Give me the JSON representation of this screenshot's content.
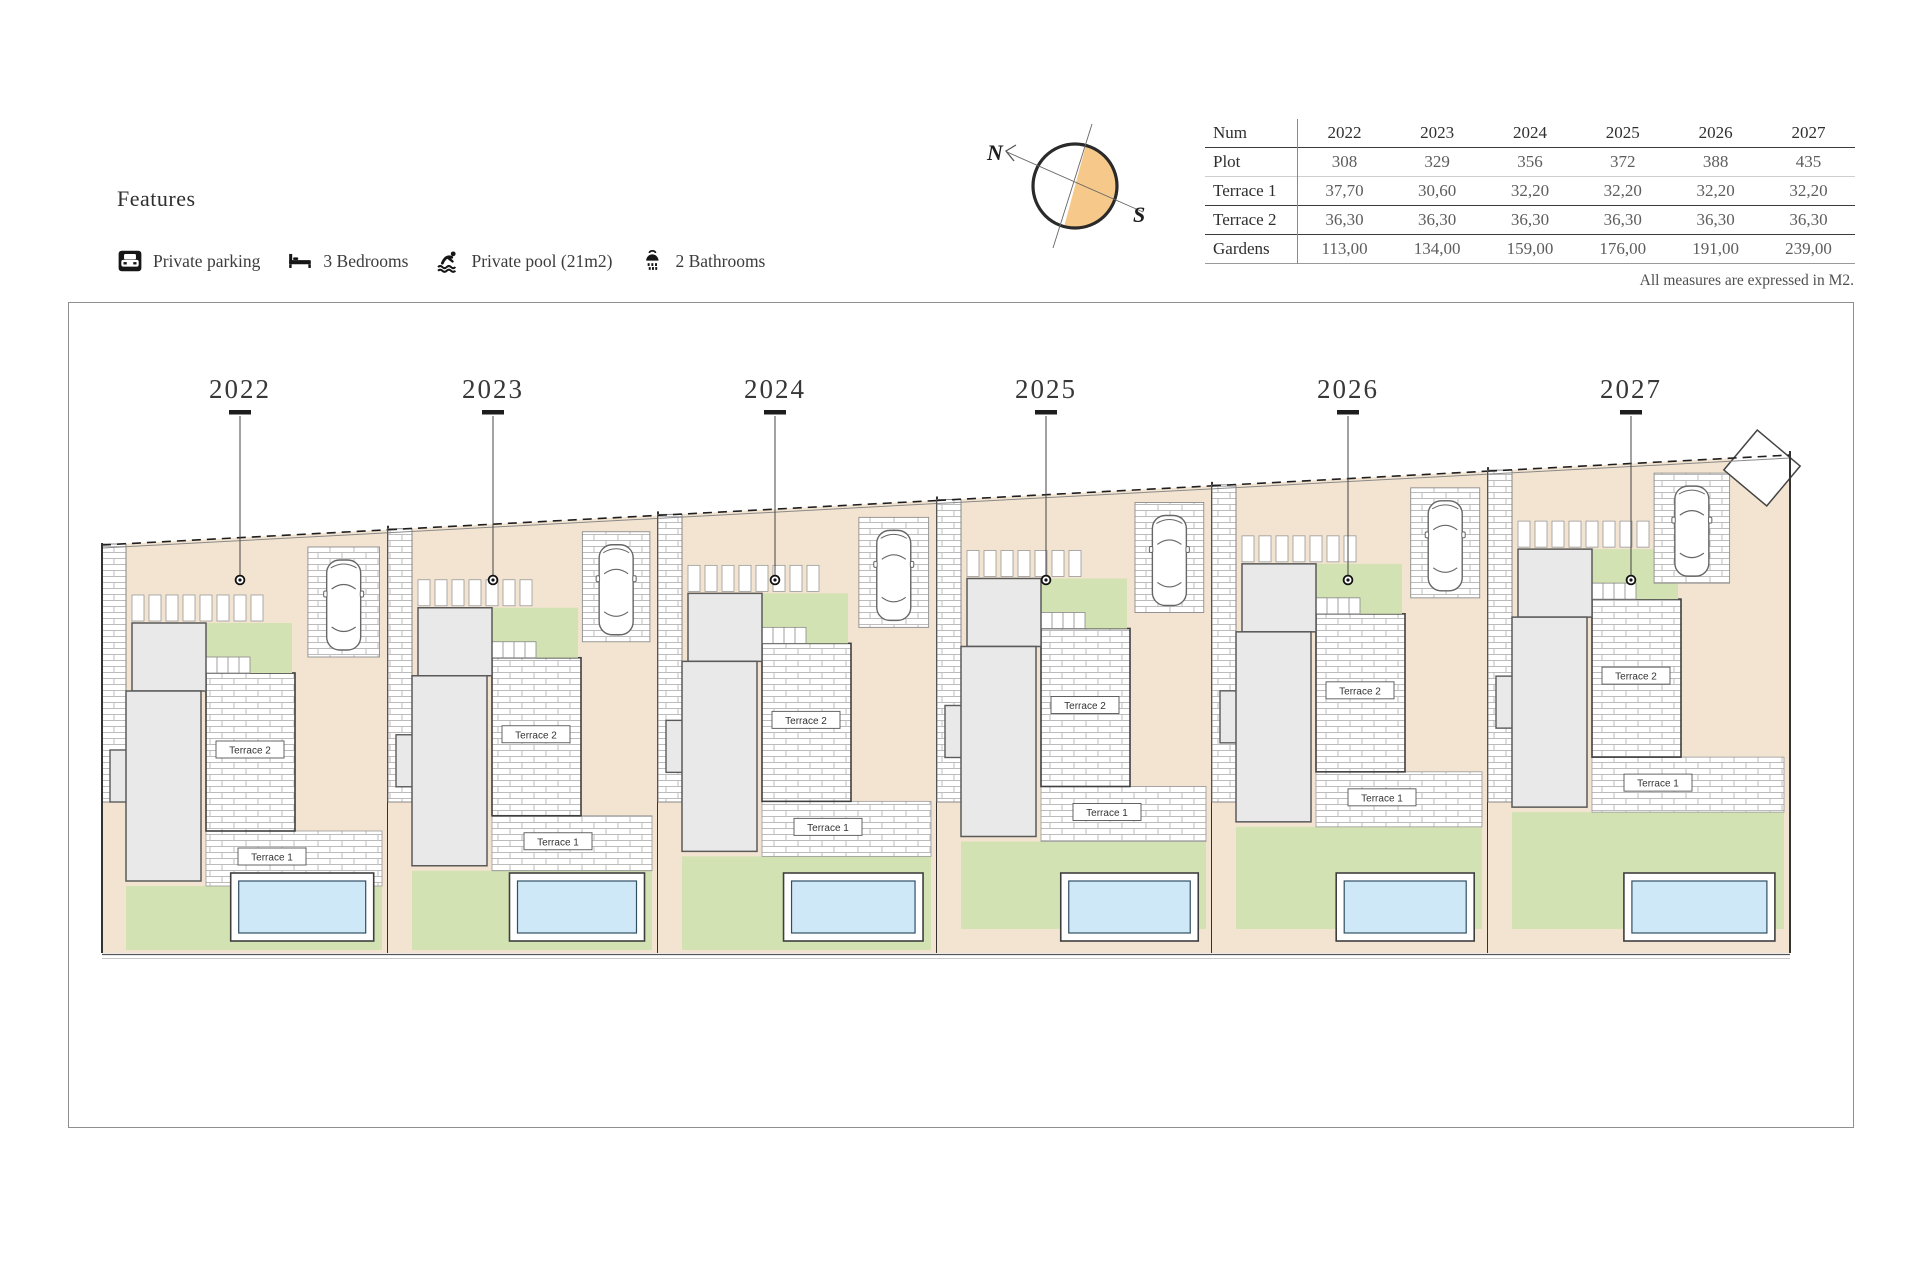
{
  "features": {
    "heading": "Features",
    "items": [
      {
        "icon": "parking-icon",
        "label": "Private parking"
      },
      {
        "icon": "bed-icon",
        "label": "3 Bedrooms"
      },
      {
        "icon": "pool-icon",
        "label": "Private pool (21m2)"
      },
      {
        "icon": "shower-icon",
        "label": "2 Bathrooms"
      }
    ]
  },
  "compass": {
    "north_label": "N",
    "south_label": "S",
    "fill_color": "#f6c98a"
  },
  "table": {
    "header": [
      "Num",
      "2022",
      "2023",
      "2024",
      "2025",
      "2026",
      "2027"
    ],
    "rows": [
      {
        "label": "Plot",
        "values": [
          "308",
          "329",
          "356",
          "372",
          "388",
          "435"
        ]
      },
      {
        "label": "Terrace 1",
        "values": [
          "37,70",
          "30,60",
          "32,20",
          "32,20",
          "32,20",
          "32,20"
        ]
      },
      {
        "label": "Terrace 2",
        "values": [
          "36,30",
          "36,30",
          "36,30",
          "36,30",
          "36,30",
          "36,30"
        ]
      },
      {
        "label": "Gardens",
        "values": [
          "113,00",
          "134,00",
          "159,00",
          "176,00",
          "191,00",
          "239,00"
        ]
      }
    ],
    "note": "All measures are expressed in M2."
  },
  "siteplan": {
    "terrace1_label": "Terrace 1",
    "terrace2_label": "Terrace 2",
    "colors": {
      "beige": "#f3e4d1",
      "green": "#d3e2b2",
      "pool_water": "#cfe8f8",
      "house_fill": "#e9e9e9",
      "brick_line": "#bcbcbc",
      "outline": "#3c3c3c"
    },
    "plots": [
      {
        "id": "2022",
        "label": "2022",
        "x": 102,
        "width": 286,
        "cx": 240
      },
      {
        "id": "2023",
        "label": "2023",
        "x": 388,
        "width": 270,
        "cx": 493
      },
      {
        "id": "2024",
        "label": "2024",
        "x": 658,
        "width": 279,
        "cx": 775
      },
      {
        "id": "2025",
        "label": "2025",
        "x": 937,
        "width": 275,
        "cx": 1046,
        "beige_bottom": true
      },
      {
        "id": "2026",
        "label": "2026",
        "x": 1212,
        "width": 276,
        "cx": 1348,
        "beige_bottom": true
      },
      {
        "id": "2027",
        "label": "2027",
        "x": 1488,
        "width": 302,
        "cx": 1631,
        "beige_bottom": true,
        "diamond": true,
        "car_frac": 0.55
      }
    ]
  }
}
